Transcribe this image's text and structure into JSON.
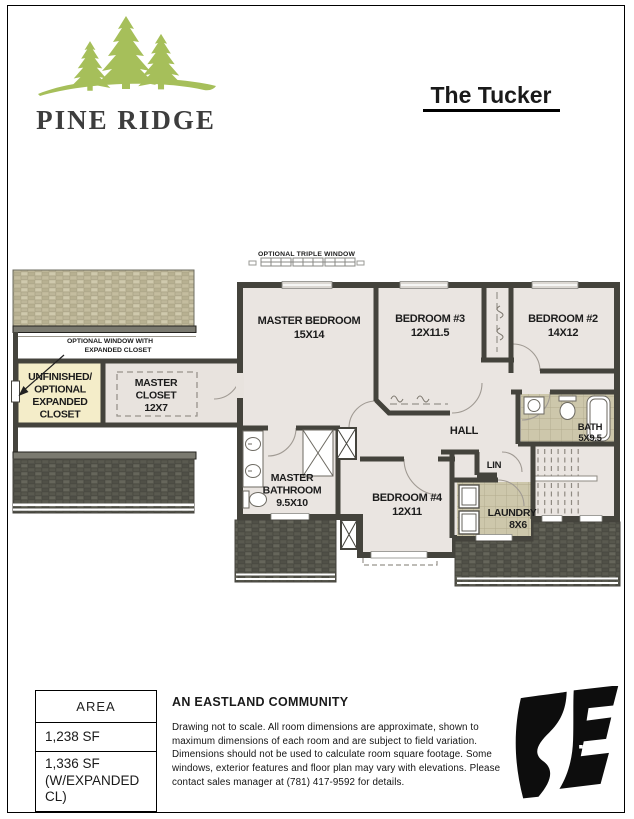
{
  "header": {
    "brand": "PINE RIDGE",
    "plan_title": "The Tucker"
  },
  "plan": {
    "annotations": {
      "triple_window": "OPTIONAL TRIPLE WINDOW",
      "expanded_window_line1": "OPTIONAL WINDOW WITH",
      "expanded_window_line2": "EXPANDED CLOSET"
    },
    "rooms": {
      "master_bedroom": {
        "name": "MASTER BEDROOM",
        "dims": "15X14"
      },
      "bedroom3": {
        "name": "BEDROOM #3",
        "dims": "12X11.5"
      },
      "bedroom2": {
        "name": "BEDROOM #2",
        "dims": "14X12"
      },
      "bedroom4": {
        "name": "BEDROOM #4",
        "dims": "12X11"
      },
      "master_closet": {
        "line1": "MASTER",
        "line2": "CLOSET",
        "dims": "12X7"
      },
      "unfinished_closet": {
        "line1": "UNFINISHED/",
        "line2": "OPTIONAL",
        "line3": "EXPANDED",
        "line4": "CLOSET"
      },
      "master_bathroom": {
        "line1": "MASTER",
        "line2": "BATHROOM",
        "dims": "9.5X10"
      },
      "hall": {
        "name": "HALL"
      },
      "lin": {
        "name": "LIN"
      },
      "bath": {
        "name": "BATH",
        "dims": "5X9.5"
      },
      "laundry": {
        "name": "LAUNDRY",
        "dims": "8X6"
      }
    }
  },
  "footer": {
    "area_table": {
      "header": "AREA",
      "row1": "1,238 SF",
      "row2_line1": "1,336 SF",
      "row2_line2": "(W/EXPANDED CL)"
    },
    "community_heading": "AN EASTLAND COMMUNITY",
    "disclaimer": "Drawing not to scale. All room dimensions are approximate, shown to maximum dimensions of each room and are subject to field variation. Dimensions should not be used to calculate room square footage. Some windows, exterior features and floor plan may vary with elevations. Please contact sales manager at (781) 417-9592 for details."
  },
  "colors": {
    "brand_green": "#a6bf5a",
    "wall_dark": "#44433c",
    "room_fill": "#eae5e1",
    "closet_yellow": "#f4edc9",
    "roof_light": "#c8c2a6",
    "roof_dark": "#5e5e53",
    "tile_khaki": "#cdc7ab",
    "logo_black": "#0d0d0d"
  }
}
